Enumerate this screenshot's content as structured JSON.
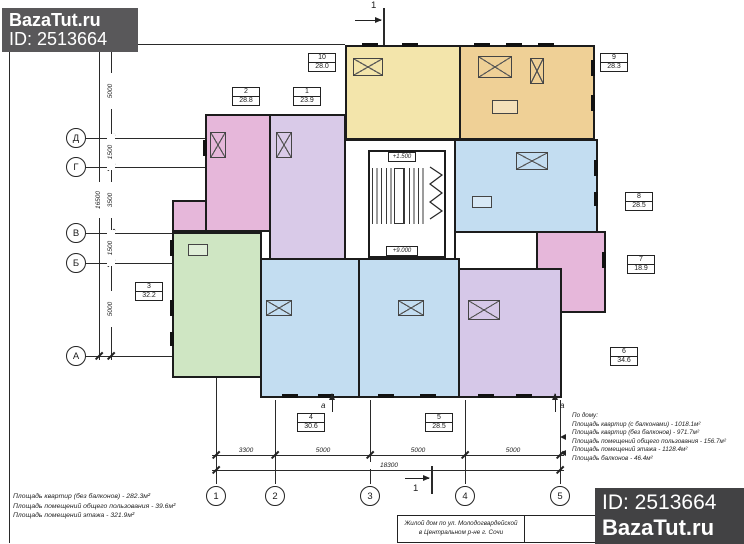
{
  "watermarks": {
    "top": {
      "site": "BazaTut.ru",
      "id": "ID: 2513664",
      "bg": "#59585a"
    },
    "bottom": {
      "id": "ID: 2513664",
      "site": "BazaTut.ru",
      "bg": "#424244"
    }
  },
  "plan": {
    "apartments": [
      {
        "num": "1",
        "area": "23.9",
        "color": "#d9cae8"
      },
      {
        "num": "2",
        "area": "28.8",
        "color": "#e6b7da"
      },
      {
        "num": "3",
        "area": "32.2",
        "color": "#cfe6c3"
      },
      {
        "num": "4",
        "area": "30.6",
        "color": "#c3ddf1"
      },
      {
        "num": "5",
        "area": "28.5",
        "color": "#c3ddf1"
      },
      {
        "num": "6",
        "area": "34.6",
        "color": "#d6c8e8"
      },
      {
        "num": "7",
        "area": "18.9",
        "color": "#e6b7da"
      },
      {
        "num": "8",
        "area": "28.5",
        "color": "#c3ddf1"
      },
      {
        "num": "9",
        "area": "28.3",
        "color": "#efd096"
      },
      {
        "num": "10",
        "area": "28.0",
        "color": "#f3e5ab"
      }
    ],
    "corridor_color": "#ffffff",
    "axes": {
      "left": [
        "Д",
        "Г",
        "В",
        "Б",
        "А"
      ],
      "bottom": [
        "1",
        "2",
        "3",
        "4",
        "5"
      ]
    },
    "dims": {
      "bottom_segments": [
        "3300",
        "5000",
        "5000",
        "5000"
      ],
      "bottom_total": "18300",
      "left_segments": [
        "5000",
        "1500",
        "3500",
        "1500",
        "5000"
      ],
      "left_total": "16500"
    },
    "elevations": {
      "stair_mid": "+1.500",
      "floor": "+9.000"
    },
    "sections": {
      "main": "1",
      "aux": "а"
    }
  },
  "notes": {
    "floor": {
      "line1": "Площадь квартир (без балконов) - 282.3м²",
      "line2": "Площадь помещений общего пользования - 39.6м²",
      "line3": "Площадь помещений этажа - 321.9м²"
    },
    "building": {
      "title": "По дому:",
      "line1": "Площадь квартир (с балконами) - 1018.1м²",
      "line2": "Площадь квартир (без балконов) - 971.7м²",
      "line3": "Площадь помещений общего пользования - 156.7м²",
      "line4": "Площадь помещений этажа - 1128.4м²",
      "line5": "Площадь балконов - 46.4м²"
    }
  },
  "titleblock": {
    "object_line1": "Жилой дом по ул. Молодогвардейской",
    "object_line2": "в Центральном р-не г. Сочи",
    "sheet_line1": "План мансардного этажа",
    "sheet_line2": "на отм. +9.000 М 1:100"
  }
}
